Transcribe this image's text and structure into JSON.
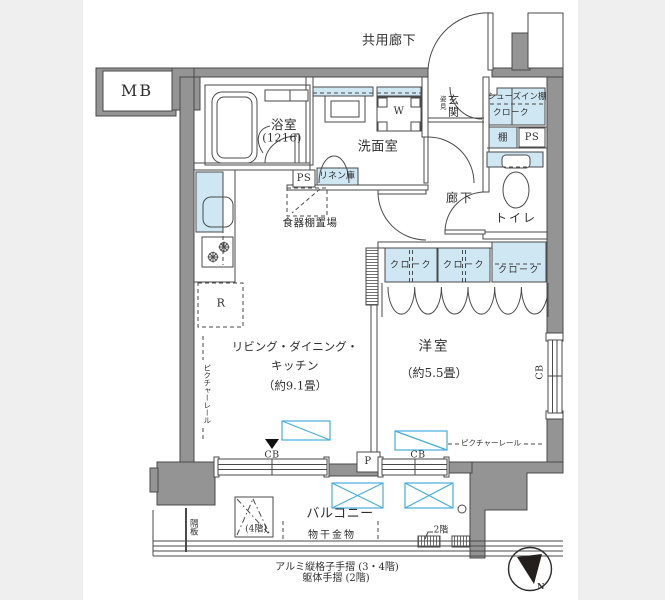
{
  "colors": {
    "background": "#efefef",
    "plan_background": "#ffffff",
    "wall_fill": "#949494",
    "line": "#4a4a4a",
    "highlight_fill": "#cfe7f3",
    "window_marker_blue": "#45aedd",
    "text": "#2f2f2f"
  },
  "labels": {
    "common_corridor": "共用廊下",
    "mb": "MB",
    "bathroom": "浴室",
    "bathroom_size": "(1216)",
    "washroom": "洗面室",
    "washer": "W",
    "entrance": "玄関",
    "mirror": "姿見",
    "shoes_shelf": "シューズイン棚",
    "shoes_cloak": "クローク",
    "shelf": "棚",
    "ps_right": "PS",
    "ps_left": "PS",
    "linen": "リネン庫",
    "cupboard_area": "食器棚置場",
    "hallway": "廊下",
    "toilet": "トイレ",
    "closet1": "クローク",
    "closet2": "クローク",
    "closet3": "クローク",
    "ldk_line1": "リビング・ダイニング・",
    "ldk_line2": "キッチン",
    "ldk_size": "（約9.1畳）",
    "western_room": "洋室",
    "western_size": "（約5.5畳）",
    "fridge": "R",
    "pole": "P",
    "cb_ldk": "CB",
    "cb_western": "CB",
    "cb_side": "CB",
    "picture_rail_left": "ピクチャーレール",
    "picture_rail_bottom": "ピクチャーレール",
    "balcony": "バルコニー",
    "laundry_fitting": "物干金物",
    "partition_board": "隔板",
    "hatch_floor": "(4階)",
    "rail_floor": "2階",
    "handrail_aluminum": "アルミ縦格子手摺 (3・4階)",
    "handrail_frame": "躯体手摺 (2階)",
    "north": "N"
  }
}
